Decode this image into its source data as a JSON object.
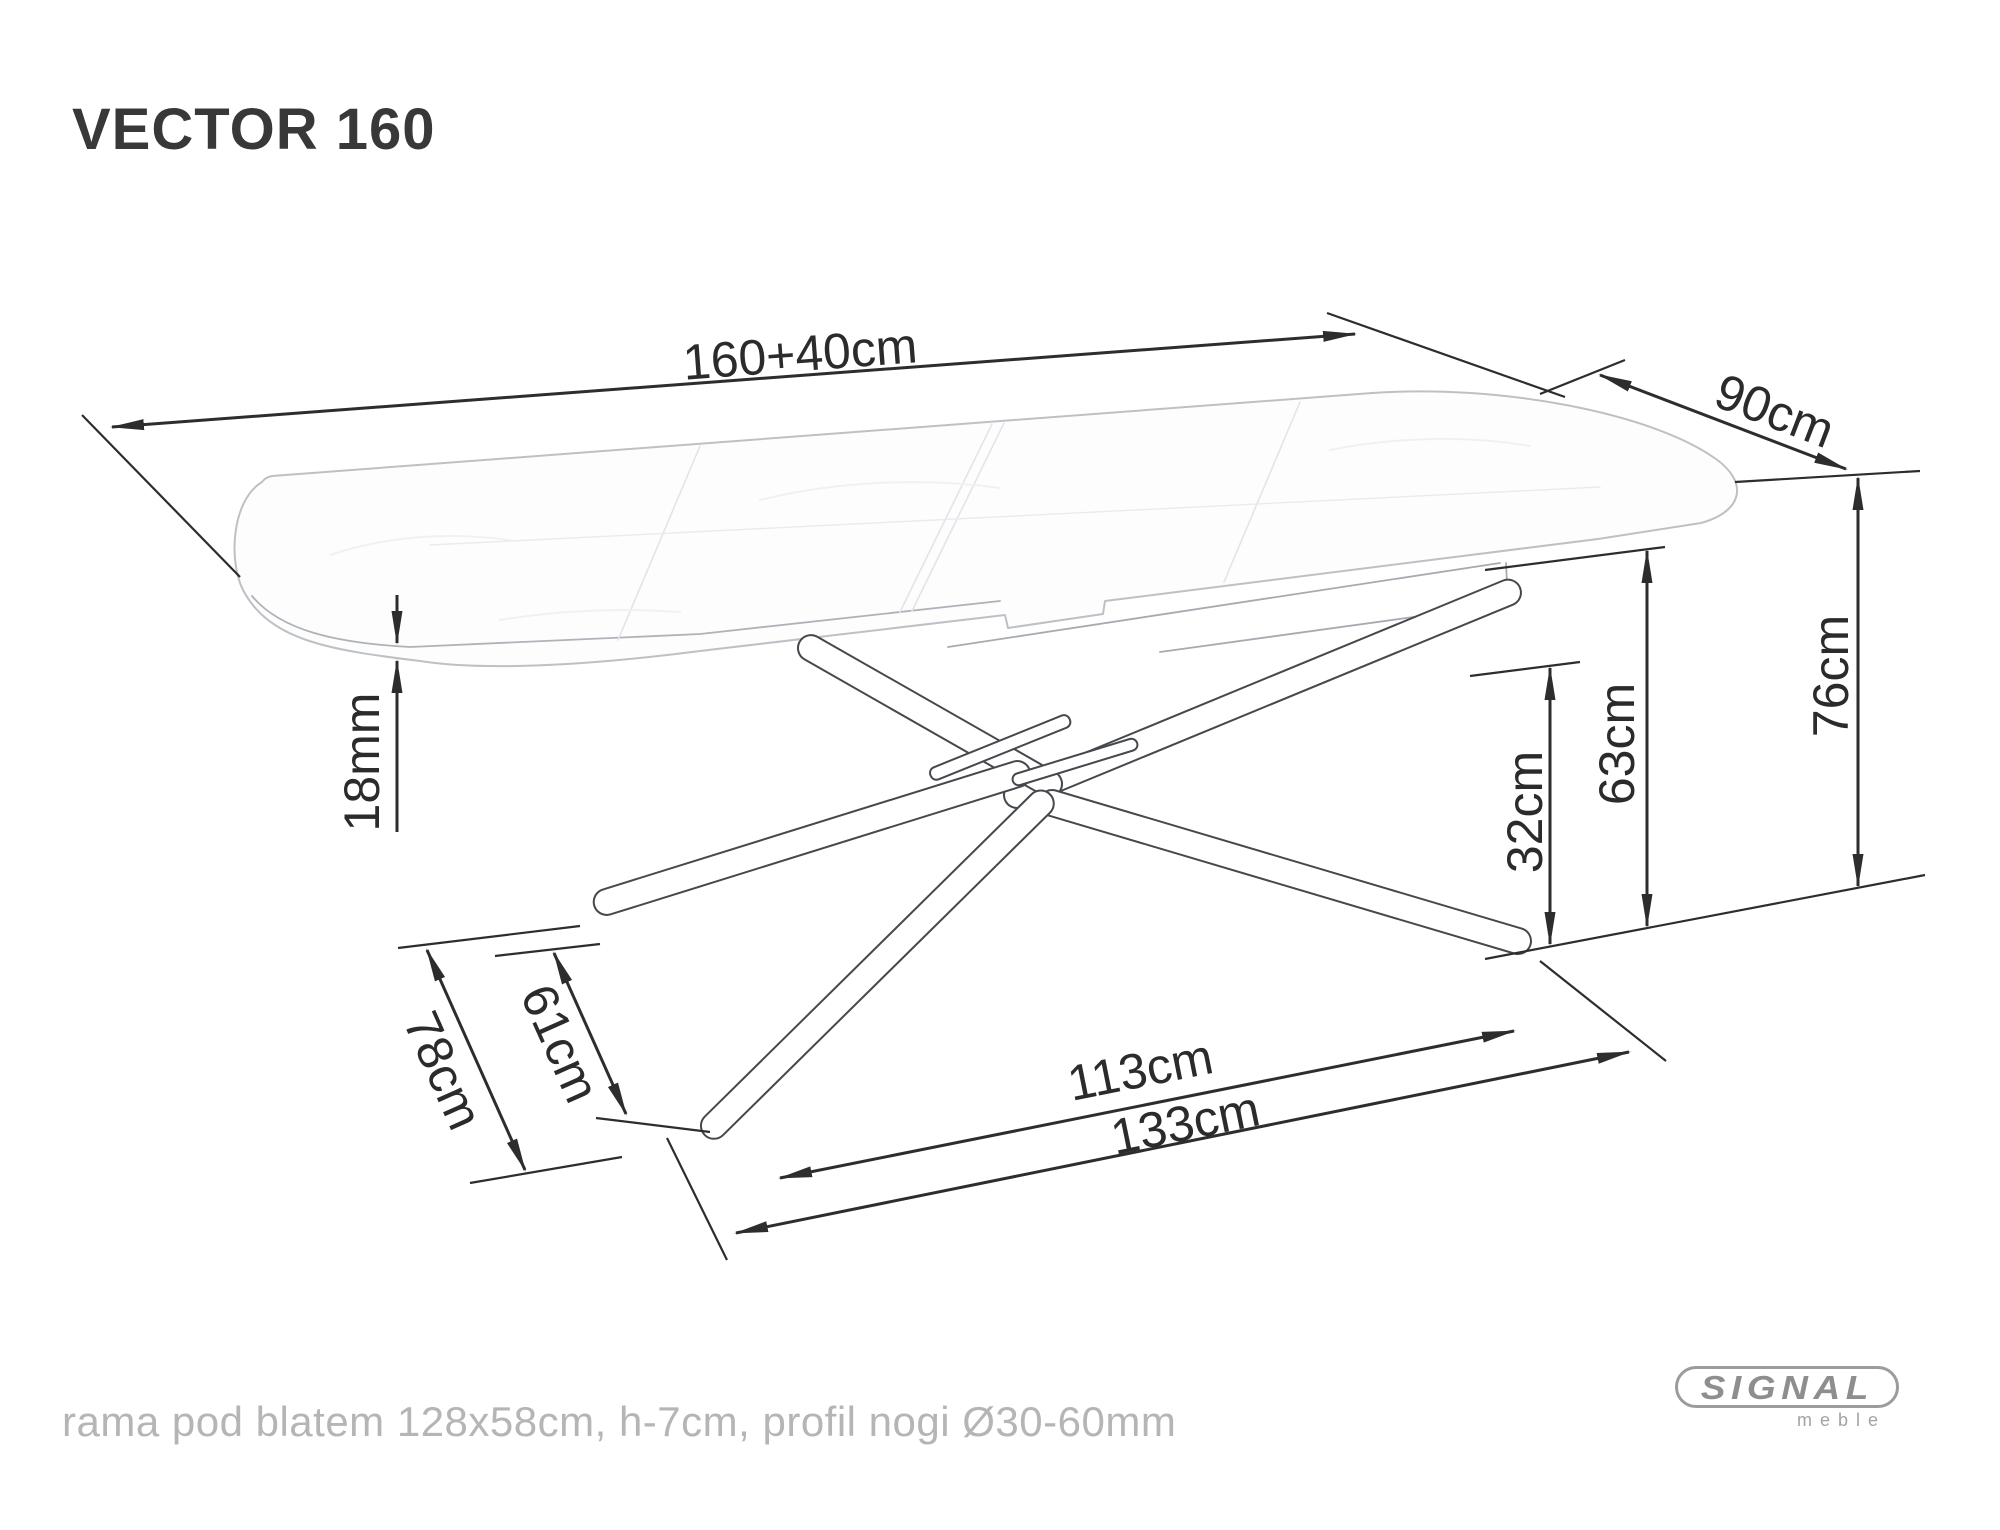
{
  "title": "VECTOR 160",
  "footer_note": "rama pod blatem 128x58cm, h-7cm, profil nogi Ø30-60mm",
  "logo": {
    "brand": "SIGNAL",
    "sub": "meble"
  },
  "drawing": {
    "subject": "VECTOR 160 extendable dining table - technical dimension drawing",
    "ink": "#2d2d2d",
    "label_font_size": 50,
    "dimensions": [
      {
        "id": "tabletop-length",
        "label": "160+40cm",
        "lines": [
          [
            112,
            427,
            1355,
            334,
            "both"
          ]
        ],
        "lx": 800,
        "ly": 353,
        "rot": -4.3
      },
      {
        "id": "tabletop-depth",
        "label": "90cm",
        "lines": [
          [
            1600,
            375,
            1846,
            469,
            "both"
          ]
        ],
        "lx": 1775,
        "ly": 410,
        "rot": 21
      },
      {
        "id": "table-height",
        "label": "76cm",
        "lines": [
          [
            1858,
            478,
            1858,
            886,
            "both"
          ]
        ],
        "lx": 1830,
        "ly": 676,
        "rot": -90
      },
      {
        "id": "underframe-height",
        "label": "63cm",
        "lines": [
          [
            1647,
            551,
            1647,
            926,
            "both"
          ]
        ],
        "lx": 1616,
        "ly": 744,
        "rot": -90
      },
      {
        "id": "hub-height",
        "label": "32cm",
        "lines": [
          [
            1550,
            668,
            1550,
            944,
            "both"
          ]
        ],
        "lx": 1524,
        "ly": 812,
        "rot": -90
      },
      {
        "id": "top-thickness",
        "label": "18mm",
        "lines": [
          [
            397,
            595,
            397,
            643,
            "end"
          ],
          [
            397,
            661,
            397,
            832,
            "start"
          ]
        ],
        "lx": 361,
        "ly": 762,
        "rot": -90
      },
      {
        "id": "feet-span-side",
        "label": "78cm",
        "lines": [
          [
            427,
            950,
            525,
            1170,
            "both"
          ]
        ],
        "lx": 444,
        "ly": 1070,
        "rot": 66
      },
      {
        "id": "feet-gap-side",
        "label": "61cm",
        "lines": [
          [
            554,
            953,
            626,
            1114,
            "both"
          ]
        ],
        "lx": 561,
        "ly": 1043,
        "rot": 66
      },
      {
        "id": "feet-span-inner",
        "label": "113cm",
        "lines": [
          [
            780,
            1178,
            1514,
            1031,
            "both"
          ]
        ],
        "lx": 1140,
        "ly": 1069,
        "rot": -11.3
      },
      {
        "id": "feet-span-outer",
        "label": "133cm",
        "lines": [
          [
            736,
            1233,
            1629,
            1052,
            "both"
          ]
        ],
        "lx": 1185,
        "ly": 1122,
        "rot": -11.6
      }
    ],
    "extension_lines": [
      [
        82,
        415,
        240,
        577
      ],
      [
        1327,
        313,
        1565,
        397
      ],
      [
        1540,
        394,
        1625,
        360
      ],
      [
        1735,
        482,
        1920,
        471
      ],
      [
        1485,
        959,
        1925,
        875
      ],
      [
        1485,
        570,
        1665,
        547
      ],
      [
        1470,
        676,
        1580,
        662
      ],
      [
        398,
        948,
        580,
        926
      ],
      [
        470,
        1183,
        622,
        1157
      ],
      [
        495,
        956,
        600,
        944
      ],
      [
        596,
        1118,
        710,
        1132
      ],
      [
        667,
        1138,
        727,
        1260
      ],
      [
        1540,
        961,
        1666,
        1061
      ]
    ]
  }
}
